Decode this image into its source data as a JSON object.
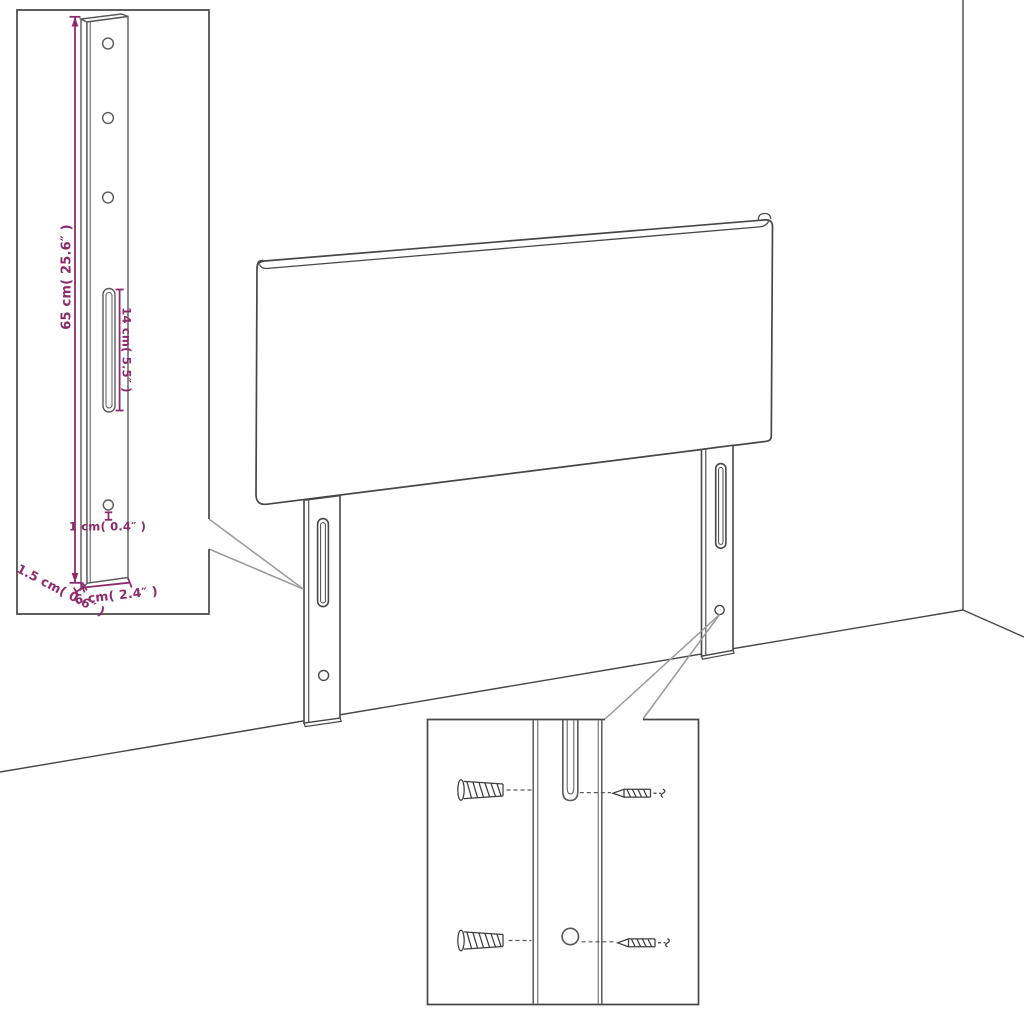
{
  "diagram": {
    "subject": "headboard-with-mounting-bracket-legs",
    "colors": {
      "outline": "#474747",
      "callout": "#9a9a9a",
      "dimension": "#8e2a6b",
      "background": "#ffffff"
    },
    "bracket_inset": {
      "hole_count": 3,
      "labels": {
        "height": "65 cm( 25.6″ )",
        "slot_length": "14 cm( 5.5″ )",
        "hole_offset": "1 cm( 0.4″ )",
        "depth": "1.5 cm( 0.6″ )",
        "width": "6 cm( 2.4″ )"
      }
    },
    "hardware_inset": {
      "rows": 2,
      "parts": [
        "wall-plug",
        "screw"
      ]
    }
  }
}
